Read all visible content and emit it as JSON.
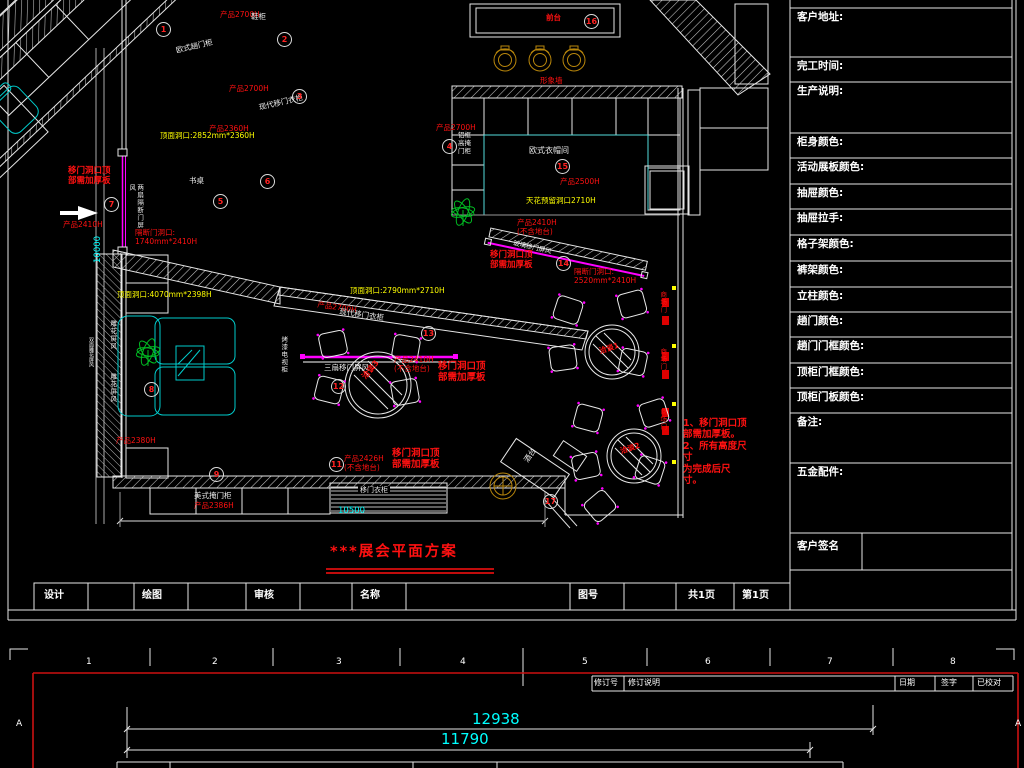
{
  "colors": {
    "red": "#ff1111",
    "yellow": "#ffff00",
    "cyan": "#00ffff",
    "magenta": "#ff00ff",
    "teal": "#00cccc",
    "green": "#00bb22",
    "gold": "#b8860b",
    "border_red": "#cc1111",
    "line": "#e6e6e6"
  },
  "panel": {
    "rows": [
      "客户地址:",
      "完工时间:",
      "生产说明:",
      "柜身颜色:",
      "活动展板颜色:",
      "抽屉颜色:",
      "抽屉拉手:",
      "格子架颜色:",
      "裤架颜色:",
      "立柱颜色:",
      "趟门颜色:",
      "趟门门框颜色:",
      "顶柜门框颜色:",
      "顶柜门板颜色:",
      "备注:",
      "五金配件:",
      "客户签名"
    ]
  },
  "title_bar": {
    "cells": [
      "设计",
      "绘图",
      "审核",
      "名称",
      "图号",
      "共1页",
      "第1页"
    ]
  },
  "plan": {
    "title": "***展会平面方案",
    "dims": {
      "h": "10500",
      "v": "10000"
    },
    "labels": {
      "p2700_a": "产品2700H",
      "xiegui": "鞋柜",
      "oushi": "欧式趟门柜",
      "p2700_b": "产品2700H",
      "xiandai_a": "现代移门衣柜",
      "p2360": "产品2360H",
      "dk_a": "顶面洞口:2852mm*2360H",
      "shuzhuo": "书桌",
      "jiahouban_l": "移门洞口顶\n部需加厚板",
      "p2410_l": "产品2410H",
      "liangshan": "两扇隔断门屏风",
      "gddk_l": "隔断门洞口:\n1740mm*2410H",
      "qiantai": "前台",
      "xingxiang": "形象墙",
      "p2700_c": "产品2700H",
      "lvkuang": "铝框\n高掩\n门柜",
      "yimaojian": "欧式衣帽间",
      "p2500": "产品2500H",
      "tianhua": "天花预留洞口2710H",
      "p2410_m": "产品2410H\n(不含地台)",
      "bolimen": "玻璃移门屏风",
      "jiahouban_r": "移门洞口顶\n部需加厚板",
      "gddk_r": "隔断门洞口:\n2520mm*2410H",
      "dk_b": "顶面洞口:2790mm*2710H",
      "p2700_d": "产品2700H",
      "xiandai_b": "现代移门衣柜",
      "dk_c": "顶面洞口:4070mm*2398H",
      "kaoqi": "烤漆电视柜",
      "sanshan": "三扇移门屏风",
      "p2410_c": "产品2410H\n(不含地台)",
      "jiahouban_m": "移门洞口顶\n部需加厚板",
      "qiatan3": "洽谈3",
      "diaohua1": "雕花屏风",
      "diaohua2": "雕花屏风",
      "shuangmian": "双面雕花屏风",
      "p2380": "产品2380H",
      "meishi": "美式掩门柜",
      "p2386": "产品2386H",
      "p2426": "产品2426H\n(不含地台)",
      "jiahouban_b": "移门洞口顶\n部需加厚板",
      "yimen_label": "移门衣柜",
      "jiutai": "酒台",
      "qiatan1": "洽谈1",
      "qiatan2": "洽谈2",
      "men": "商场门",
      "note": "1、移门洞口顶\n部需加厚板。\n2、所有高度尺寸\n为完成后尺寸。"
    },
    "circles": {
      "c1": "1",
      "c2": "2",
      "c3": "3",
      "c4": "4",
      "c5": "5",
      "c6": "6",
      "c7": "7",
      "c8": "8",
      "c9": "9",
      "c11": "11",
      "c12": "12",
      "c13": "13",
      "c14": "14",
      "c15": "15",
      "c16": "16",
      "c17": "17"
    }
  },
  "bottom": {
    "ruler": [
      "1",
      "2",
      "3",
      "4",
      "5",
      "6",
      "7",
      "8"
    ],
    "revision": [
      "修订号",
      "修订说明",
      "日期",
      "签字",
      "已校对"
    ],
    "dims": {
      "d1": "12938",
      "d2": "11790"
    },
    "edge_letter": "A"
  }
}
